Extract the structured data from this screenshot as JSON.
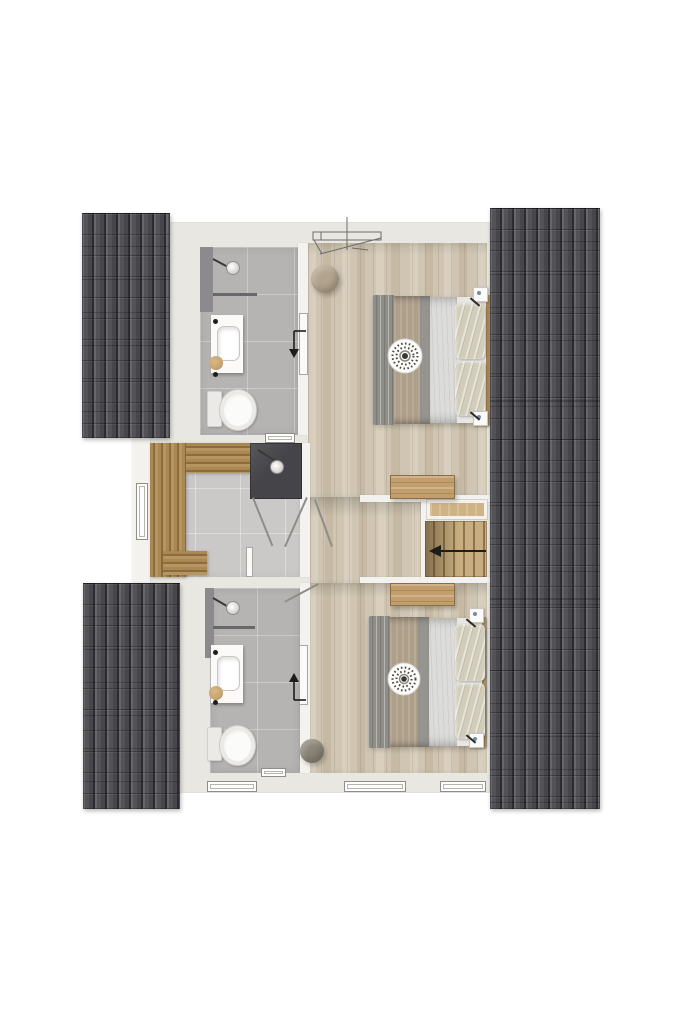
{
  "palette": {
    "background": "#ffffff",
    "wallSlab": "#e9e7e2",
    "wallLight": "#f3f2ee",
    "roofBase": "#525257",
    "roofLight": "#66666b",
    "roofShade": "#46464b",
    "roofJoint": "#2c2c30",
    "woodA": "#d8cfbe",
    "woodB": "#cfc5b2",
    "woodC": "#c6baa5",
    "tileBath": "#b6b4b2",
    "tileSauna": "#cbc9c7",
    "saunaWoodA": "#aa8852",
    "saunaWoodB": "#8c6c3e",
    "saunaWoodC": "#b79562",
    "showerDark": "#454449",
    "stairA": "#c7ad80",
    "stairB": "#8d744e",
    "nicheWood": "#cfb285",
    "benchWood": "#c29e6c",
    "benchBorder": "#8a6e45",
    "bedBase": "#e8e7e3",
    "bedDrape": "#8f8d88",
    "bedBlanketTan": "#ae9f8a",
    "bedGrayStrip": "#96948e",
    "bedSheet": "#dcdcda",
    "pillow": "#d2cdbb",
    "headboard": "#bd9964",
    "poufTan": "#b2a38c",
    "poufGray": "#8a8376",
    "fixtureWhite": "#fbfaf8",
    "fixtureBorder": "#c9c7c2",
    "glassDark": "#68676b",
    "arrow": "#1c1c1a",
    "lineColor": "#8f8d88"
  },
  "plan": {
    "type": "floor-plan-3d-render",
    "rooms": [
      {
        "name": "bathroom-top",
        "fixtures": [
          "shower-head",
          "glass-shelf",
          "vanity-sink",
          "toilet"
        ],
        "door_swing_arrow": "down"
      },
      {
        "name": "bedroom-top",
        "fixtures": [
          "double-bed",
          "two-pillows",
          "decor-plate",
          "round-pouf",
          "nightstand",
          "foot-bench"
        ]
      },
      {
        "name": "sauna",
        "fixtures": [
          "l-shaped-slat-bench",
          "dark-shower-corner",
          "shower-head"
        ]
      },
      {
        "name": "hallway",
        "fixtures": [
          "door-swings"
        ]
      },
      {
        "name": "staircase",
        "fixtures": [
          "wood-treads",
          "landing-niche"
        ],
        "direction_arrow": "left"
      },
      {
        "name": "bathroom-bottom",
        "fixtures": [
          "shower-head",
          "glass-shelf",
          "vanity-sink",
          "toilet"
        ],
        "door_swing_arrow": "up"
      },
      {
        "name": "bedroom-bottom",
        "fixtures": [
          "double-bed",
          "two-pillows",
          "decor-plate",
          "round-pouf",
          "nightstand",
          "foot-bench"
        ]
      }
    ],
    "roof_sections": [
      "left-top",
      "left-bottom",
      "right-full-height"
    ],
    "window_symbols": {
      "left_wall": 1,
      "bottom_wall": 3,
      "interior_small": 2,
      "top_wall_skylight": 1
    }
  }
}
